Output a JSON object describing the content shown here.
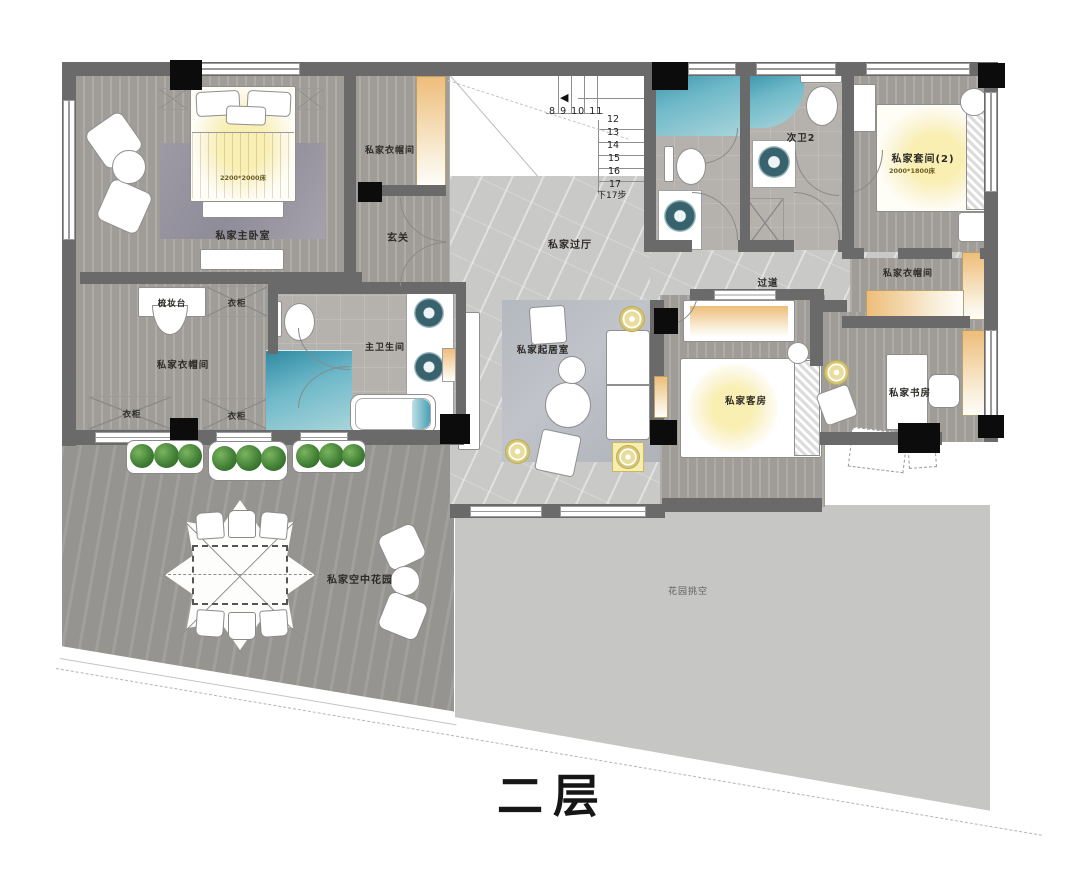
{
  "title": "二层",
  "labels": {
    "master_bedroom": "私家主卧室",
    "master_bed_size": "2200*2000床",
    "cloakroom_top": "私家衣帽间",
    "entry": "玄关",
    "hall": "私家过厅",
    "bath2": "次卫2",
    "suite2": "私家套间(2)",
    "suite2_bed_size": "2000*1800床",
    "cloakroom_right": "私家衣帽间",
    "corridor": "过道",
    "dressing_table": "梳妆台",
    "wardrobe_top": "衣柜",
    "cloakroom_left": "私家衣帽间",
    "wardrobe_bottom_left": "衣柜",
    "wardrobe_bottom_right": "衣柜",
    "master_bath": "主卫生间",
    "living_room": "私家起居室",
    "guest_room": "私家客房",
    "study": "私家书房",
    "sky_garden": "私家空中花园",
    "garden_void": "花园挑空"
  },
  "stairs": {
    "upper_numbers": "8 9 10 11",
    "steps": [
      "12",
      "13",
      "14",
      "15",
      "16",
      "17"
    ],
    "note": "下17步",
    "arrow": "◀"
  },
  "colors": {
    "wall": "#6a6a6a",
    "column": "#0c0c0c",
    "accent_orange": "#eebd7a",
    "shower_blue": "#2f8aa3",
    "glow_yellow": "#f9efb3",
    "plant_green": "#3f7d34"
  }
}
